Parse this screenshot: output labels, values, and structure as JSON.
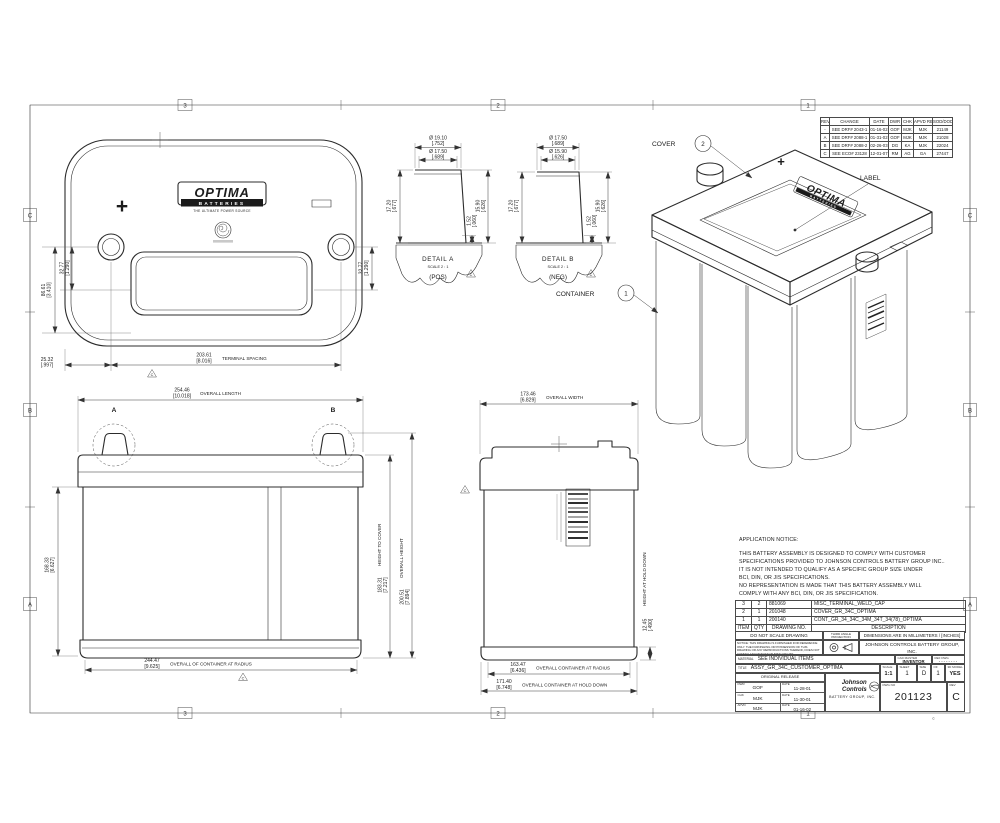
{
  "sheet": {
    "zone_cols": [
      "3",
      "2",
      "1"
    ],
    "zone_rows": [
      "C",
      "B",
      "A"
    ],
    "copyright": "©"
  },
  "marks": {
    "plus": "+"
  },
  "logo": {
    "name": "OPTIMA",
    "bar": "BATTERIES",
    "tagline": "THE ULTIMATE POWER SOURCE"
  },
  "top_view": {
    "dim_left_outer_mm": "86.61",
    "dim_left_outer_in": "[3.410]",
    "dim_left_inner_mm": "32.77",
    "dim_left_inner_in": "[1.290]",
    "dim_right_mm": "32.77",
    "dim_right_in": "[1.290]",
    "dim_offset_mm": "25.32",
    "dim_offset_in": "[.997]",
    "dim_spacing_mm": "203.61",
    "dim_spacing_in": "[8.016]",
    "dim_spacing_label": "TERMINAL SPACING",
    "flag": "C"
  },
  "detail_a": {
    "title": "DETAIL  A",
    "scale": "SCALE 2 : 1",
    "polarity": "(POS)",
    "flag": "C",
    "dia1_mm": "Ø 19.10",
    "dia1_in": "[.752]",
    "dia2_mm": "Ø 17.50",
    "dia2_in": "[.689]",
    "h_mm": "17.20",
    "h_in": "[.677]",
    "lip_mm": "1.52",
    "lip_in": "[.060]",
    "post_mm": "15.90",
    "post_in": "[.626]"
  },
  "detail_b": {
    "title": "DETAIL  B",
    "scale": "SCALE 2 : 1",
    "polarity": "(NEG)",
    "flag": "C",
    "dia1_mm": "Ø 17.50",
    "dia1_in": "[.689]",
    "dia2_mm": "Ø 15.90",
    "dia2_in": "[.626]",
    "h_mm": "17.20",
    "h_in": "[.677]",
    "lip_mm": "1.52",
    "lip_in": "[.060]",
    "post_mm": "15.90",
    "post_in": "[.626]"
  },
  "front_view": {
    "length_mm": "254.46",
    "length_in": "[10.018]",
    "length_label": "OVERALL LENGTH",
    "left_mm": "168.33",
    "left_in": "[6.627]",
    "cover_mm": "183.31",
    "cover_in": "[7.217]",
    "cover_label": "HEIGHT TO COVER",
    "overall_mm": "200.51",
    "overall_in": "[7.894]",
    "overall_label": "OVERALL HEIGHT",
    "radius_mm": "244.47",
    "radius_in": "[9.625]",
    "radius_label": "OVERALL OF CONTAINER AT RADIUS",
    "mark_a": "A",
    "mark_b": "B",
    "flag": "C"
  },
  "side_view": {
    "width_mm": "173.46",
    "width_in": "[6.829]",
    "width_label": "OVERALL WIDTH",
    "hold_mm": "12.45",
    "hold_in": "[.490]",
    "hold_label": "HEIGHT AT HOLD DOWN",
    "radius_mm": "163.47",
    "radius_in": "[6.436]",
    "radius_label": "OVERALL CONTAINER AT RADIUS",
    "holddown_mm": "171.40",
    "holddown_in": "[6.748]",
    "holddown_label": "OVERALL CONTAINER AT HOLD DOWN",
    "flag": "C"
  },
  "iso": {
    "cover_label": "COVER",
    "cover_num": "2",
    "label_label": "LABEL",
    "container_label": "CONTAINER",
    "container_num": "1"
  },
  "revisions": {
    "headers": [
      "REV",
      "CHANGE",
      "DATE",
      "DWR",
      "CHK",
      "APVD REQ",
      "SOD/DOD#"
    ],
    "rows": [
      [
        "-",
        "SEE DRF# 2043-1",
        "01-16-02",
        "GOF",
        "MJK",
        "MJK",
        "21149"
      ],
      [
        "A",
        "SEE DRF# 2088-1",
        "01-31-02",
        "GOF",
        "MJK",
        "MJK",
        "21028"
      ],
      [
        "B",
        "SEE DRF# 2088-2",
        "02-26-03",
        "DG",
        "KA",
        "MJK",
        "22024"
      ],
      [
        "C",
        "SEE ECO# 23128",
        "12-01-07",
        "RM",
        "AG",
        "GA",
        "27447"
      ]
    ]
  },
  "notice": {
    "title": "APPLICATION NOTICE:",
    "lines": [
      "THIS BATTERY ASSEMBLY IS DESIGNED TO COMPLY WITH CUSTOMER",
      "SPECIFICATIONS PROVIDED TO JOHNSON CONTROLS BATTERY GROUP INC..",
      "IT IS NOT INTENDED TO QUALIFY AS A SPECIFIC GROUP SIZE UNDER",
      "BCI, DIN, OR JIS SPECIFICATIONS.",
      "NO REPRESENTATION IS MADE THAT THIS BATTERY ASSEMBLY WILL",
      "COMPLY WITH ANY BCI, DIN, OR JIS SPECIFICATION."
    ]
  },
  "bom": {
    "headers": [
      "ITEM",
      "QTY",
      "DRAWING NO.",
      "DESCRIPTION"
    ],
    "rows": [
      [
        "3",
        "2",
        "881069",
        "MISC_TERMINAL_WELD_CAP"
      ],
      [
        "2",
        "1",
        "201048",
        "COVER_GR_34C_OPTIMA"
      ],
      [
        "1",
        "1",
        "200140",
        "CONT_GR_34_34C_34M_34T_34(78)_OPTIMA"
      ]
    ]
  },
  "title_block": {
    "do_not_scale": "DO NOT SCALE DRAWING",
    "third_angle": "THIRD ANGLE PROJECTION",
    "units": "DIMENSIONS ARE IN MILLIMETERS / [INCHES]",
    "legal": "NOTICE: THIS DRAWING IS FURNISHED FOR REFERENCE ONLY. THE FURNISHING OR POSSESSION OF THIS DRAWING OR ANY REPRODUCTIONS THEREOF, DOES NOT CONVEY ANY MANUFACTURING RIGHTS.",
    "company": "JOHNSON CONTROLS BATTERY GROUP, INC.",
    "confidential": "CONFIDENTIAL AND PROPRIETARY INFORMATION",
    "material_label": "MATERIAL",
    "material": "SEE INDIVIDUAL ITEMS",
    "cad_label": "CAD MASTER",
    "cad": "INVENTOR",
    "ref_label": "REF DWG",
    "ref": "--------",
    "title_label": "TITLE",
    "title": "ASSY_GR_34C_CUSTOMER_OPTIMA",
    "scale_label": "SCALE",
    "scale": "1:1",
    "sheet_label": "SHEET",
    "sheet": "1",
    "size_label": "SIZE",
    "size": "D",
    "of_label": "OF",
    "of": "1",
    "model_label": "3D MODEL",
    "model": "YES",
    "release_header": "ORIGINAL RELEASE",
    "release_rows": [
      {
        "role": "DWR",
        "name": "GOF",
        "date_label": "DATE",
        "date": "11-28-01"
      },
      {
        "role": "CHK",
        "name": "MJK",
        "date_label": "DATE",
        "date": "11-30-01"
      },
      {
        "role": "APVD",
        "name": "MJK",
        "date_label": "DATE",
        "date": "01-16-02"
      }
    ],
    "brand_name": "Johnson Controls",
    "brand_sub": "BATTERY GROUP, INC.",
    "dwg_label": "DWG NO",
    "dwg_no": "201123",
    "rev_label": "REV",
    "rev": "C"
  }
}
